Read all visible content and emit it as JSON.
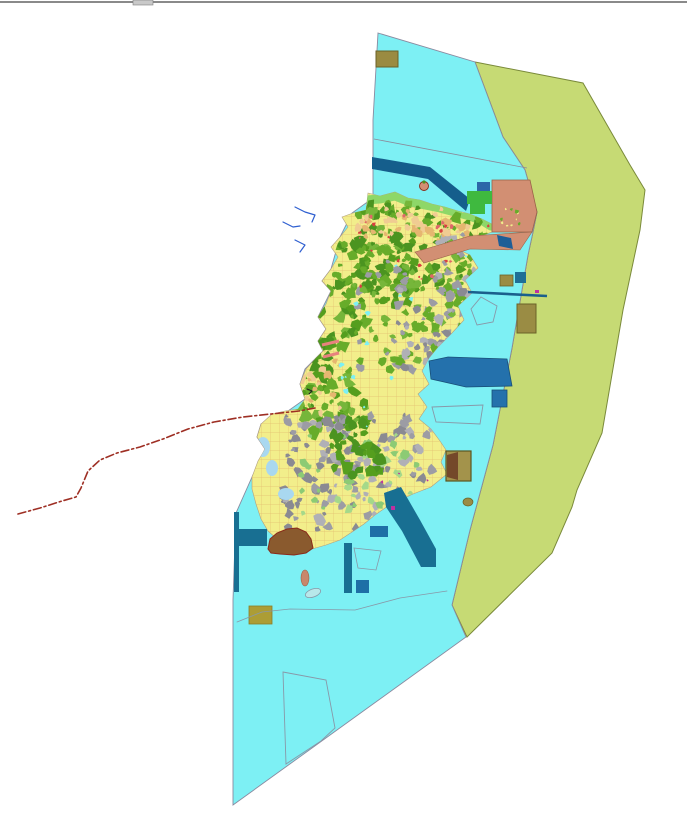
{
  "window": {
    "topbar": {
      "bar_color": "#8a8a8a",
      "handle_color": "#c9c9c9",
      "handle_border": "#7d7d7d",
      "bar_y": 1,
      "bar_h": 2,
      "handle_x": 133,
      "handle_w": 20,
      "handle_h": 5
    }
  },
  "palette": {
    "water": "#7df0f4",
    "water_border": "#8a8aa0",
    "offshore_zone": "#c6da74",
    "offshore_border": "#7a8a3a",
    "island_base": "#f2ee8b",
    "island_border": "#b0a080",
    "parcel_mesh": "#dfb066",
    "forest_greens": [
      "#559e1e",
      "#67ac2a",
      "#4b9420",
      "#76b63a"
    ],
    "urban_grays": [
      "#9c9ca4",
      "#b0b0b6",
      "#8a8a92"
    ],
    "soil_oranges": [
      "#f0cc92",
      "#e6b670"
    ],
    "coast_green": "#8ed768",
    "bright_green": "#3fb93f",
    "harbor_blue": "#2471ac",
    "pier_teal": "#186f92",
    "band_blue": "#155e8c",
    "salmon": "#d28f73",
    "salmon_border": "#9a6248",
    "khaki": "#9a8c44",
    "khaki_dark_border": "#6b6228",
    "khaki_yellow": "#ac9d35",
    "brown": "#8a5a2e",
    "brown_border": "#8a2a1a",
    "stream_blue": "#2f5fd0",
    "boundary_red": "#9e2f24",
    "pink_pier": "#e8827e",
    "magenta": "#c030a0",
    "outline_gray": "#8898a8",
    "lagoon_blue": "#a9d8f0"
  },
  "map": {
    "width": 687,
    "height": 821,
    "island_outline": "368,193 380,196 395,192 408,198 420,200 432,204 445,207 458,211 470,214 482,219 492,224 492,232 470,240 455,248 470,255 478,268 465,280 472,293 458,306 464,320 452,333 438,347 429,358 422,371 429,384 418,394 427,407 419,419 431,429 440,441 446,450 441,462 447,474 431,487 413,494 400,500 388,506 375,515 364,524 352,532 340,540 326,545 312,549 299,549 288,545 277,539 268,531 261,519 256,504 252,489 252,477 258,461 265,449 257,437 261,424 272,414 285,411 298,409 305,399 300,384 306,369 316,358 323,351 318,341 326,329 318,317 326,304 331,291 322,281 331,269 338,257 331,247 340,237 348,227 342,217 353,213 366,210",
    "layers": [
      {
        "type": "polygon",
        "name": "offshore-zone",
        "inter": true,
        "points": "475,62 583,83 630,165 645,190 640,230 623,310 602,433 577,490 572,507 552,553 467,637 452,605 470,530 493,445 512,348 528,255 533,232 537,212 525,170 503,137",
        "fill": "#c6da74",
        "stroke": "#7a8a3a",
        "sw": 1
      },
      {
        "type": "polygon",
        "name": "water-area",
        "inter": true,
        "points": "378,33 475,62 503,137 525,170 537,212 533,232 528,255 512,348 493,445 470,530 452,605 466,637 233,805 233,600 236,513 252,477 265,449 257,437 261,424 288,411 305,399 300,384 305,369 323,351 318,341 326,329 318,317 331,291 322,281 331,269 340,237 352,213 373,198 373,120",
        "fill": "#7df0f4",
        "stroke": "#8a8aa0",
        "sw": 0.9
      },
      {
        "type": "line",
        "name": "offshore-survey-line",
        "inter": false,
        "x1": 374,
        "y1": 139,
        "x2": 527,
        "y2": 168,
        "stroke": "#8a8a9a",
        "sw": 0.8
      },
      {
        "type": "polygon",
        "name": "breakwater-band",
        "inter": true,
        "points": "372,157 430,167 470,199 466,211 428,179 372,169",
        "fill": "#155e8c",
        "stroke": "none",
        "sw": 0
      },
      {
        "type": "island-base",
        "name": "island",
        "inter": true,
        "fill": "#f2ee8b",
        "stroke": "#b0a080",
        "sw": 0.6
      },
      {
        "type": "mesh",
        "name": "parcel-mesh",
        "inter": false,
        "clip": true,
        "size": 9,
        "stroke": "#dfb066",
        "sw": 0.7,
        "opacity": 0.75
      },
      {
        "type": "path-stroke",
        "name": "north-coast-strip",
        "inter": false,
        "clip": true,
        "points": "366,200 380,199 395,196 410,202 425,205 440,208 455,212 470,216 483,221 491,226",
        "stroke": "#8ed768",
        "sw": 9
      },
      {
        "type": "blobs",
        "name": "north-forest",
        "inter": false,
        "clip": true,
        "x": 352,
        "y": 200,
        "w": 140,
        "h": 90,
        "n": 150,
        "rmin": 2,
        "rmax": 7,
        "colors": [
          "#559e1e",
          "#67ac2a",
          "#4b9420",
          "#76b63a"
        ],
        "seed": 11
      },
      {
        "type": "blobs",
        "name": "neck-forest",
        "inter": false,
        "clip": true,
        "x": 330,
        "y": 240,
        "w": 80,
        "h": 70,
        "n": 60,
        "rmin": 2,
        "rmax": 6,
        "colors": [
          "#559e1e",
          "#67ac2a",
          "#4b9420"
        ],
        "seed": 21
      },
      {
        "type": "blobs",
        "name": "midwest-forest",
        "inter": false,
        "clip": true,
        "x": 298,
        "y": 285,
        "w": 70,
        "h": 150,
        "n": 110,
        "rmin": 2,
        "rmax": 7,
        "colors": [
          "#559e1e",
          "#67ac2a",
          "#4b9420",
          "#76b63a"
        ],
        "seed": 31
      },
      {
        "type": "blobs",
        "name": "central-parcels",
        "inter": false,
        "clip": true,
        "x": 355,
        "y": 260,
        "w": 110,
        "h": 110,
        "n": 70,
        "rmin": 2,
        "rmax": 5,
        "colors": [
          "#67ac2a",
          "#76b63a",
          "#9c9ca4"
        ],
        "seed": 41
      },
      {
        "type": "blobs",
        "name": "northeast-mixed",
        "inter": false,
        "clip": true,
        "x": 435,
        "y": 235,
        "w": 70,
        "h": 55,
        "n": 45,
        "rmin": 2,
        "rmax": 5,
        "colors": [
          "#9c9ca4",
          "#e6b670",
          "#67ac2a",
          "#b0b0b6"
        ],
        "seed": 51
      },
      {
        "type": "blobs",
        "name": "east-urban",
        "inter": false,
        "clip": true,
        "x": 395,
        "y": 285,
        "w": 85,
        "h": 85,
        "n": 95,
        "rmin": 2,
        "rmax": 6,
        "colors": [
          "#9c9ca4",
          "#b0b0b6",
          "#8a8a92",
          "#67ac2a"
        ],
        "seed": 61
      },
      {
        "type": "blobs",
        "name": "south-urban",
        "inter": false,
        "clip": true,
        "x": 283,
        "y": 415,
        "w": 150,
        "h": 115,
        "n": 150,
        "rmin": 2,
        "rmax": 6,
        "colors": [
          "#9c9ca4",
          "#b0b0b6",
          "#8a8a92"
        ],
        "seed": 71
      },
      {
        "type": "blobs",
        "name": "south-lightgreen",
        "inter": false,
        "clip": true,
        "x": 300,
        "y": 430,
        "w": 120,
        "h": 90,
        "n": 40,
        "rmin": 2,
        "rmax": 5,
        "colors": [
          "#8ccb74",
          "#a5d98a"
        ],
        "seed": 81
      },
      {
        "type": "blobs",
        "name": "south-forest",
        "inter": false,
        "clip": true,
        "x": 328,
        "y": 420,
        "w": 55,
        "h": 55,
        "n": 35,
        "rmin": 3,
        "rmax": 7,
        "colors": [
          "#559e1e",
          "#4b9420"
        ],
        "seed": 91
      },
      {
        "type": "blobs",
        "name": "coast-soil-north",
        "inter": false,
        "clip": true,
        "x": 355,
        "y": 205,
        "w": 135,
        "h": 35,
        "n": 45,
        "rmin": 2,
        "rmax": 5,
        "colors": [
          "#f0cc92",
          "#e6b670"
        ],
        "seed": 101
      },
      {
        "type": "blobs",
        "name": "west-soil",
        "inter": false,
        "clip": true,
        "x": 300,
        "y": 360,
        "w": 40,
        "h": 60,
        "n": 20,
        "rmin": 2,
        "rmax": 5,
        "colors": [
          "#f0cc92",
          "#e6b670"
        ],
        "seed": 111
      },
      {
        "type": "blobs",
        "name": "village-red-dots",
        "inter": false,
        "clip": true,
        "x": 355,
        "y": 210,
        "w": 140,
        "h": 80,
        "n": 25,
        "rmin": 1,
        "rmax": 2.4,
        "colors": [
          "#d84040",
          "#e06868"
        ],
        "seed": 121
      },
      {
        "type": "blobs",
        "name": "pond-dots",
        "inter": false,
        "clip": true,
        "x": 340,
        "y": 250,
        "w": 140,
        "h": 180,
        "n": 18,
        "rmin": 1,
        "rmax": 3,
        "colors": [
          "#7df0f4"
        ],
        "seed": 131
      },
      {
        "type": "blobs",
        "name": "magenta-dots",
        "inter": false,
        "clip": true,
        "x": 380,
        "y": 470,
        "w": 60,
        "h": 60,
        "n": 10,
        "rmin": 1,
        "rmax": 2,
        "colors": [
          "#c030a0"
        ],
        "seed": 141
      },
      {
        "type": "ellipse",
        "name": "lagoon-1",
        "inter": false,
        "clip": true,
        "cx": 263,
        "cy": 447,
        "rx": 7,
        "ry": 10,
        "rot": 0,
        "fill": "#a9d8f0",
        "stroke": "none",
        "sw": 0
      },
      {
        "type": "ellipse",
        "name": "lagoon-2",
        "inter": false,
        "clip": true,
        "cx": 272,
        "cy": 468,
        "rx": 6,
        "ry": 8,
        "rot": 0,
        "fill": "#a9d8f0",
        "stroke": "none",
        "sw": 0
      },
      {
        "type": "ellipse",
        "name": "lagoon-3",
        "inter": false,
        "clip": true,
        "cx": 286,
        "cy": 494,
        "rx": 8,
        "ry": 6,
        "rot": 0,
        "fill": "#a9d8f0",
        "stroke": "none",
        "sw": 0
      },
      {
        "type": "polygon",
        "name": "salmon-zone-block",
        "inter": true,
        "points": "492,180 530,180 537,212 532,232 492,232",
        "fill": "#d28f73",
        "stroke": "#9a6248",
        "sw": 0.8
      },
      {
        "type": "polygon",
        "name": "salmon-zone-band",
        "inter": true,
        "points": "415,252 470,236 532,232 520,250 470,249 424,263",
        "fill": "#d28f73",
        "stroke": "#9a6248",
        "sw": 0.6
      },
      {
        "type": "blobs",
        "name": "salmon-speckle",
        "inter": false,
        "x": 498,
        "y": 206,
        "w": 28,
        "h": 22,
        "n": 10,
        "rmin": 1,
        "rmax": 2.2,
        "colors": [
          "#f2ee8b",
          "#67ac2a"
        ],
        "seed": 151
      },
      {
        "type": "rect",
        "name": "reclaim-green-rect",
        "inter": true,
        "x": 467,
        "y": 191,
        "w": 25,
        "h": 13,
        "fill": "#3fb93f",
        "stroke": "none",
        "sw": 0
      },
      {
        "type": "rect",
        "name": "reclaim-green-rect-2",
        "inter": true,
        "x": 470,
        "y": 204,
        "w": 15,
        "h": 10,
        "fill": "#3fb93f",
        "stroke": "none",
        "sw": 0
      },
      {
        "type": "rect",
        "name": "pier-blue-rect-ne",
        "inter": true,
        "x": 477,
        "y": 182,
        "w": 13,
        "h": 9,
        "fill": "#2c66a8",
        "stroke": "none",
        "sw": 0
      },
      {
        "type": "polygon",
        "name": "pier-parallelogram",
        "inter": true,
        "points": "497,235 511,238 513,249 499,246",
        "fill": "#1e5e96",
        "stroke": "none",
        "sw": 0
      },
      {
        "type": "line",
        "name": "east-breakwater-line",
        "inter": true,
        "x1": 468,
        "y1": 292,
        "x2": 547,
        "y2": 296,
        "stroke": "#1a5f8c",
        "sw": 2.6
      },
      {
        "type": "rect",
        "name": "khaki-square-east",
        "inter": true,
        "x": 500,
        "y": 275,
        "w": 13,
        "h": 11,
        "fill": "#9a8c44",
        "stroke": "#6b6228",
        "sw": 0.8
      },
      {
        "type": "rect",
        "name": "teal-square-east",
        "inter": true,
        "x": 515,
        "y": 272,
        "w": 11,
        "h": 11,
        "fill": "#1e6f96",
        "stroke": "none",
        "sw": 0
      },
      {
        "type": "rect",
        "name": "khaki-rect-east",
        "inter": true,
        "x": 517,
        "y": 304,
        "w": 19,
        "h": 29,
        "fill": "#9a8c44",
        "stroke": "#6b6228",
        "sw": 1
      },
      {
        "type": "polygon",
        "name": "plan-outline-pentagon",
        "inter": true,
        "points": "481,297 497,306 493,322 477,325 471,309",
        "fill": "none",
        "stroke": "#8898a8",
        "sw": 0.9
      },
      {
        "type": "polygon",
        "name": "harbor-basin",
        "inter": true,
        "points": "429,361 448,357 507,359 512,386 466,387 431,379",
        "fill": "#2471ac",
        "stroke": "#184f78",
        "sw": 0.8
      },
      {
        "type": "rect",
        "name": "harbor-small-rect",
        "inter": true,
        "x": 492,
        "y": 390,
        "w": 15,
        "h": 17,
        "fill": "#2471ac",
        "stroke": "#184f78",
        "sw": 0.8
      },
      {
        "type": "polygon",
        "name": "plan-outline-quad",
        "inter": true,
        "points": "432,407 483,405 480,424 436,422",
        "fill": "none",
        "stroke": "#8898a8",
        "sw": 0.9
      },
      {
        "type": "rect",
        "name": "facility-square-border",
        "inter": true,
        "x": 446,
        "y": 451,
        "w": 25,
        "h": 30,
        "fill": "#a3934b",
        "stroke": "#5a5520",
        "sw": 1.2
      },
      {
        "type": "polygon",
        "name": "facility-square-brown-half",
        "inter": false,
        "points": "447,455 458,452 458,480 447,477",
        "fill": "#74492a",
        "stroke": "none",
        "sw": 0
      },
      {
        "type": "ellipse",
        "name": "olive-blob-se",
        "inter": false,
        "cx": 468,
        "cy": 502,
        "rx": 5,
        "ry": 4,
        "rot": 0,
        "fill": "#9a8c44",
        "stroke": "#6b6228",
        "sw": 0.7
      },
      {
        "type": "polygon",
        "name": "southeast-channel-band",
        "inter": true,
        "points": "384,493 401,487 420,520 436,549 436,567 421,567 402,531 386,507",
        "fill": "#186f92",
        "stroke": "none",
        "sw": 0
      },
      {
        "type": "rect",
        "name": "pier-rect-se",
        "inter": true,
        "x": 370,
        "y": 526,
        "w": 18,
        "h": 11,
        "fill": "#1e6fa6",
        "stroke": "none",
        "sw": 0
      },
      {
        "type": "rect",
        "name": "magenta-dot-se",
        "inter": false,
        "x": 391,
        "y": 506,
        "w": 4,
        "h": 4,
        "fill": "#c030a0",
        "stroke": "none",
        "sw": 0
      },
      {
        "type": "rect",
        "name": "magenta-dot-e",
        "inter": false,
        "x": 535,
        "y": 290,
        "w": 4,
        "h": 3,
        "fill": "#c030a0",
        "stroke": "none",
        "sw": 0
      },
      {
        "type": "rect",
        "name": "t-pier-vertical",
        "inter": true,
        "x": 234,
        "y": 512,
        "w": 5,
        "h": 80,
        "fill": "#186f92",
        "stroke": "none",
        "sw": 0
      },
      {
        "type": "rect",
        "name": "t-pier-horizontal",
        "inter": true,
        "x": 237,
        "y": 529,
        "w": 30,
        "h": 17,
        "fill": "#186f92",
        "stroke": "none",
        "sw": 0
      },
      {
        "type": "polygon",
        "name": "reclaim-brown-area",
        "inter": true,
        "points": "268,549 270,539 277,533 287,529 297,528 306,532 311,539 313,548 306,553 294,555 280,554 271,553",
        "fill": "#8a5a2e",
        "stroke": "#8a2a1a",
        "sw": 1
      },
      {
        "type": "ellipse",
        "name": "sand-blob-south",
        "inter": false,
        "cx": 305,
        "cy": 578,
        "rx": 4,
        "ry": 8,
        "rot": 0,
        "fill": "#c8876b",
        "stroke": "#a06048",
        "sw": 0.6
      },
      {
        "type": "ellipse",
        "name": "islet-outline-south",
        "inter": true,
        "cx": 313,
        "cy": 593,
        "rx": 8,
        "ry": 4,
        "rot": -20,
        "fill": "#b8e8ea",
        "stroke": "#8898a8",
        "sw": 0.8
      },
      {
        "type": "rect",
        "name": "khaki-rect-south",
        "inter": true,
        "x": 249,
        "y": 606,
        "w": 23,
        "h": 18,
        "fill": "#ac9d35",
        "stroke": "#8a7d28",
        "sw": 0.8
      },
      {
        "type": "rect",
        "name": "pier-bar-south",
        "inter": true,
        "x": 344,
        "y": 543,
        "w": 8,
        "h": 50,
        "fill": "#186f92",
        "stroke": "none",
        "sw": 0
      },
      {
        "type": "rect",
        "name": "pier-square-south",
        "inter": true,
        "x": 356,
        "y": 580,
        "w": 13,
        "h": 13,
        "fill": "#1e6fa6",
        "stroke": "none",
        "sw": 0
      },
      {
        "type": "polygon",
        "name": "plan-outline-quad-south",
        "inter": true,
        "points": "354,548 381,551 376,570 358,568",
        "fill": "none",
        "stroke": "#8898a8",
        "sw": 0.8
      },
      {
        "type": "polyline",
        "name": "sea-boundary-polyline",
        "inter": false,
        "points": "237,622 262,612 290,609 355,610 400,598 447,591",
        "stroke": "#8898a8",
        "sw": 0.8
      },
      {
        "type": "polygon",
        "name": "plan-outline-bottom",
        "inter": true,
        "points": "283,672 326,680 335,728 321,741 286,764",
        "fill": "none",
        "stroke": "#8898a8",
        "sw": 0.9
      },
      {
        "type": "polyline",
        "name": "stream-1",
        "inter": false,
        "points": "295,207 305,212 315,215 312,222",
        "stroke": "#2f5fd0",
        "sw": 1.2
      },
      {
        "type": "polyline",
        "name": "stream-2",
        "inter": false,
        "points": "283,222 293,227 300,226",
        "stroke": "#2f5fd0",
        "sw": 1.2
      },
      {
        "type": "polyline",
        "name": "stream-3",
        "inter": false,
        "points": "295,240 305,245 300,252",
        "stroke": "#2f5fd0",
        "sw": 1.2
      },
      {
        "type": "line",
        "name": "pink-pier-1",
        "inter": true,
        "x1": 322,
        "y1": 345,
        "x2": 339,
        "y2": 341,
        "stroke": "#e8827e",
        "sw": 3
      },
      {
        "type": "line",
        "name": "pink-pier-2",
        "inter": true,
        "x1": 323,
        "y1": 357,
        "x2": 339,
        "y2": 353,
        "stroke": "#e8827e",
        "sw": 3
      },
      {
        "type": "circle",
        "name": "islet-north",
        "inter": true,
        "cx": 424,
        "cy": 186,
        "r": 4.5,
        "fill": "#d28f73",
        "stroke": "#8a2a1a",
        "sw": 0.9
      },
      {
        "type": "circle",
        "name": "islet-north-green-dot",
        "inter": false,
        "cx": 424,
        "cy": 182,
        "r": 1.6,
        "fill": "#4b9420",
        "stroke": "none",
        "sw": 0
      },
      {
        "type": "rect",
        "name": "khaki-square-top",
        "inter": true,
        "x": 376,
        "y": 51,
        "w": 22,
        "h": 16,
        "fill": "#9a8b41",
        "stroke": "#6b6228",
        "sw": 1
      },
      {
        "type": "polyline",
        "name": "red-dashed-boundary",
        "inter": true,
        "points": "18,514 40,508 62,501 76,497 81,488 88,471 100,460 117,453 140,447 163,439 188,429 214,422 243,417 271,414 299,411 315,408",
        "stroke": "#9e2f24",
        "sw": 1.6,
        "dash": "8 3 2 3"
      },
      {
        "type": "polyline",
        "name": "cursor-mark",
        "inter": false,
        "points": "307,389 312,391 309,394",
        "stroke": "#202020",
        "sw": 1.2
      }
    ]
  }
}
